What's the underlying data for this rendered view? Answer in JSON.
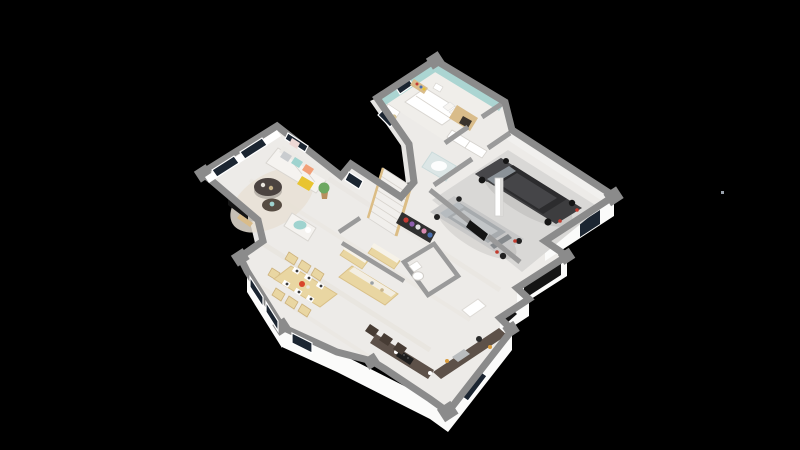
{
  "scene": {
    "type": "3d-isometric-floorplan-render",
    "background": "#000000",
    "artifact_dot_color": "#9aa2ac"
  },
  "palette": {
    "floor": "#edebe8",
    "floor_bedroom": "#f0eeea",
    "floor_garage": "#d9d8d6",
    "floor_wc": "#eceae7",
    "rug": "#e8e1d5",
    "wall_cap": "#8b8b8b",
    "wall_cap_inner": "#9a9a9a",
    "wall_face": "#fbfbfa",
    "wall_face_shade": "#e7e6e4",
    "wall_teal": "#abd5d2",
    "glazing": "#1b2531",
    "wood_light": "#e9d6a2",
    "wood_mid": "#d9bc8a",
    "counter_dark": "#5d5149",
    "stool": "#473c34",
    "sofa_white": "#f5f3f0",
    "pillow_teal": "#9fd3cf",
    "pillow_coral": "#f2a078",
    "pillow_gray": "#c9cccf",
    "chair_yellow": "#e8c431",
    "coffee_table": "#4b4340",
    "tv_screen": "#141414",
    "plant": "#6da861",
    "shower_glass": "#cfe3e5",
    "stair_wood": "#dcbd85",
    "door_dark": "#141414",
    "taillight": "#c23b2e",
    "hob_black": "#1e1e1e",
    "sink_steel": "#b9bcbe",
    "centerpiece_red": "#d8442b",
    "curtain_pink": "#eed8d5",
    "clothes": [
      "#c43c35",
      "#8e5fae",
      "#e2e2e2",
      "#d98bb1",
      "#4a6fae"
    ]
  },
  "rooms": {
    "bedroom": {
      "wall_accent": "#abd5d2",
      "furniture": [
        "double-bed",
        "headboard-wardrobe",
        "bookshelf",
        "nightstand",
        "desk"
      ]
    },
    "hall": {
      "furniture": [
        "staircase",
        "shower",
        "open-closet",
        "built-in-wardrobes"
      ]
    },
    "garage": {
      "cars": [
        {
          "name": "dark-suv",
          "body": "#3d3d3f",
          "cabin": "#2c2c2e",
          "roof": "#454548"
        },
        {
          "name": "silver-hatchback",
          "body": "#c7c7c7",
          "cabin": "#a7abae",
          "roof": "#c2c5c7"
        }
      ],
      "door": "#141414",
      "pillar": "#ffffff"
    },
    "living_room": {
      "furniture": [
        "sofa",
        "armchair",
        "yellow-chair",
        "coffee-tables",
        "tv",
        "plant",
        "rug"
      ]
    },
    "dining_area": {
      "furniture": [
        "dining-table",
        "dining-chairs",
        "place-settings"
      ]
    },
    "kitchen": {
      "furniture": [
        "island",
        "wood-cabinets",
        "bar-counter",
        "bar-stools",
        "hob",
        "sink",
        "tall-cabinet"
      ]
    },
    "wc": {
      "furniture": [
        "toilet"
      ]
    }
  }
}
